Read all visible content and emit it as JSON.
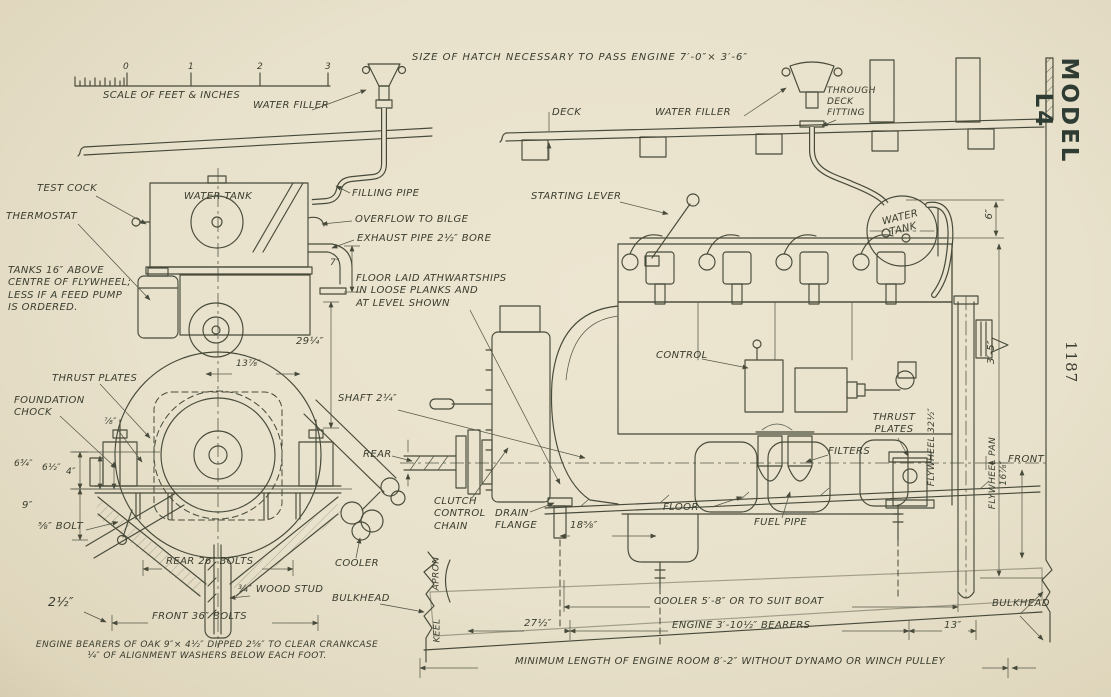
{
  "top": {
    "hatch_note": "SIZE OF HATCH NECESSARY TO PASS ENGINE 7′-0″× 3′-6″",
    "model": "MODEL L4",
    "page_number": "1187"
  },
  "scale": {
    "caption": "SCALE OF FEET & INCHES",
    "n0": "0",
    "n1": "1",
    "n2": "2",
    "n3": "3"
  },
  "front": {
    "water_filler": "WATER FILLER",
    "test_cock": "TEST COCK",
    "thermostat": "THERMOSTAT",
    "water_tank": "WATER TANK",
    "tanks_note": "TANKS 16″ ABOVE\nCENTRE OF FLYWHEEL;\nLESS IF A FEED PUMP\nIS ORDERED.",
    "filling_pipe": "FILLING PIPE",
    "overflow": "OVERFLOW TO BILGE",
    "exhaust": "EXHAUST PIPE 2½″ BORE",
    "thrust_plates": "THRUST PLATES",
    "foundation_chock": "FOUNDATION\nCHOCK",
    "bolt": "⅝″ BOLT",
    "rear_bolts": "REAR 26″ BOLTS",
    "front_bolts": "FRONT 36″ BOLTS",
    "wood_stud": "¾″ WOOD STUD",
    "cooler": "COOLER",
    "shaft": "SHAFT 2¼″",
    "rear": "REAR",
    "bearers_note": "ENGINE BEARERS OF OAK 9″× 4½″ DIPPED 2⅝″ TO CLEAR CRANKCASE\n¼″ OF ALIGNMENT WASHERS BELOW EACH FOOT.",
    "dims": {
      "exhaust_h": "7″",
      "height": "29¼″",
      "hub": "13⅞″",
      "plate": "⅞″",
      "a": "6¾″",
      "b": "6½″",
      "c": "4″",
      "d": "9″",
      "e": "2½″"
    }
  },
  "side": {
    "deck": "DECK",
    "water_filler": "WATER FILLER",
    "through_deck": "THROUGH\nDECK\nFITTING",
    "starting_lever": "STARTING LEVER",
    "water_tank": "WATER\nTANK",
    "floor_note": "FLOOR LAID ATHWARTSHIPS\nIN LOOSE PLANKS AND\nAT LEVEL SHOWN",
    "control": "CONTROL",
    "filters": "FILTERS",
    "thrust_plates": "THRUST\nPLATES",
    "front": "FRONT",
    "fuel_pipe": "FUEL PIPE",
    "floor": "FLOOR",
    "clutch_chain": "CLUTCH\nCONTROL\nCHAIN",
    "drain_flange": "DRAIN\nFLANGE",
    "bulkhead_left": "BULKHEAD",
    "bulkhead_right": "BULKHEAD",
    "apron": "APRON",
    "keel": "KEEL",
    "min_length": "MINIMUM LENGTH OF ENGINE ROOM 8′-2″ WITHOUT DYNAMO OR WINCH PULLEY",
    "dims": {
      "tank": "6″",
      "overall": "3′-5″",
      "flywheel": "FLYWHEEL 32½″",
      "flywheel_pan": "FLYWHEEL PAN\n16⅞″",
      "drain": "18⅝″",
      "front_off": "27½″",
      "cooler": "COOLER 5′-8″ OR TO SUIT BOAT",
      "bearers": "ENGINE 3′-10½″ BEARERS",
      "aft": "13″"
    }
  },
  "colors": {
    "paper": "#e8e1cb",
    "ink": "#474a3a"
  }
}
